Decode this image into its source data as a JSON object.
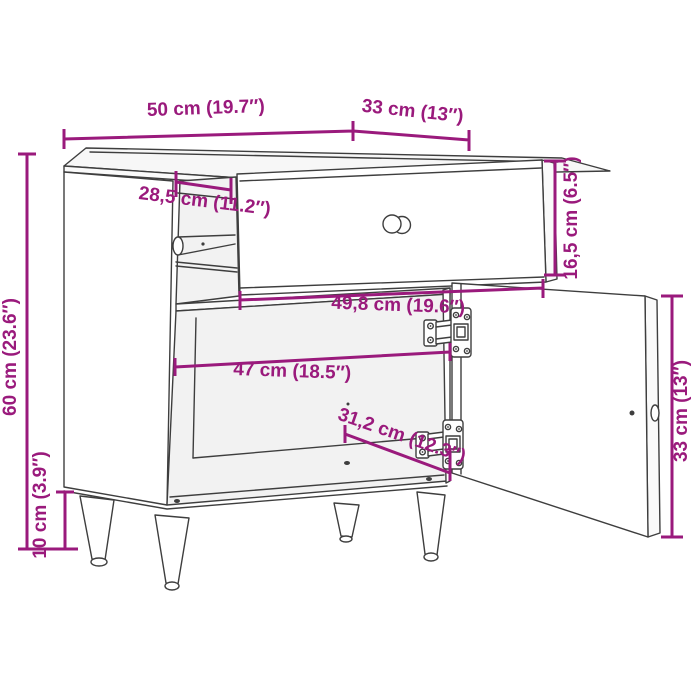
{
  "title": "Bedside cabinet dimension diagram",
  "colors": {
    "dimension": "#9a1a7c",
    "outline": "#3e3e3e",
    "background": "#ffffff"
  },
  "dims": {
    "width_top": {
      "label": "50 cm (19.7″)"
    },
    "depth_top": {
      "label": "33 cm (13″)"
    },
    "height_total": {
      "label": "60 cm (23.6″)"
    },
    "leg_height": {
      "label": "10 cm (3.9″)"
    },
    "drawer_inner_depth": {
      "label": "28,5 cm (11.2″)"
    },
    "drawer_front_height": {
      "label": "16,5 cm (6.5″)"
    },
    "drawer_front_width": {
      "label": "49,8 cm (19.6″)"
    },
    "interior_width": {
      "label": "47 cm (18.5″)"
    },
    "interior_bottom_width": {
      "label": "31,2 cm (12.3″)"
    },
    "door_height": {
      "label": "33 cm (13″)"
    }
  }
}
